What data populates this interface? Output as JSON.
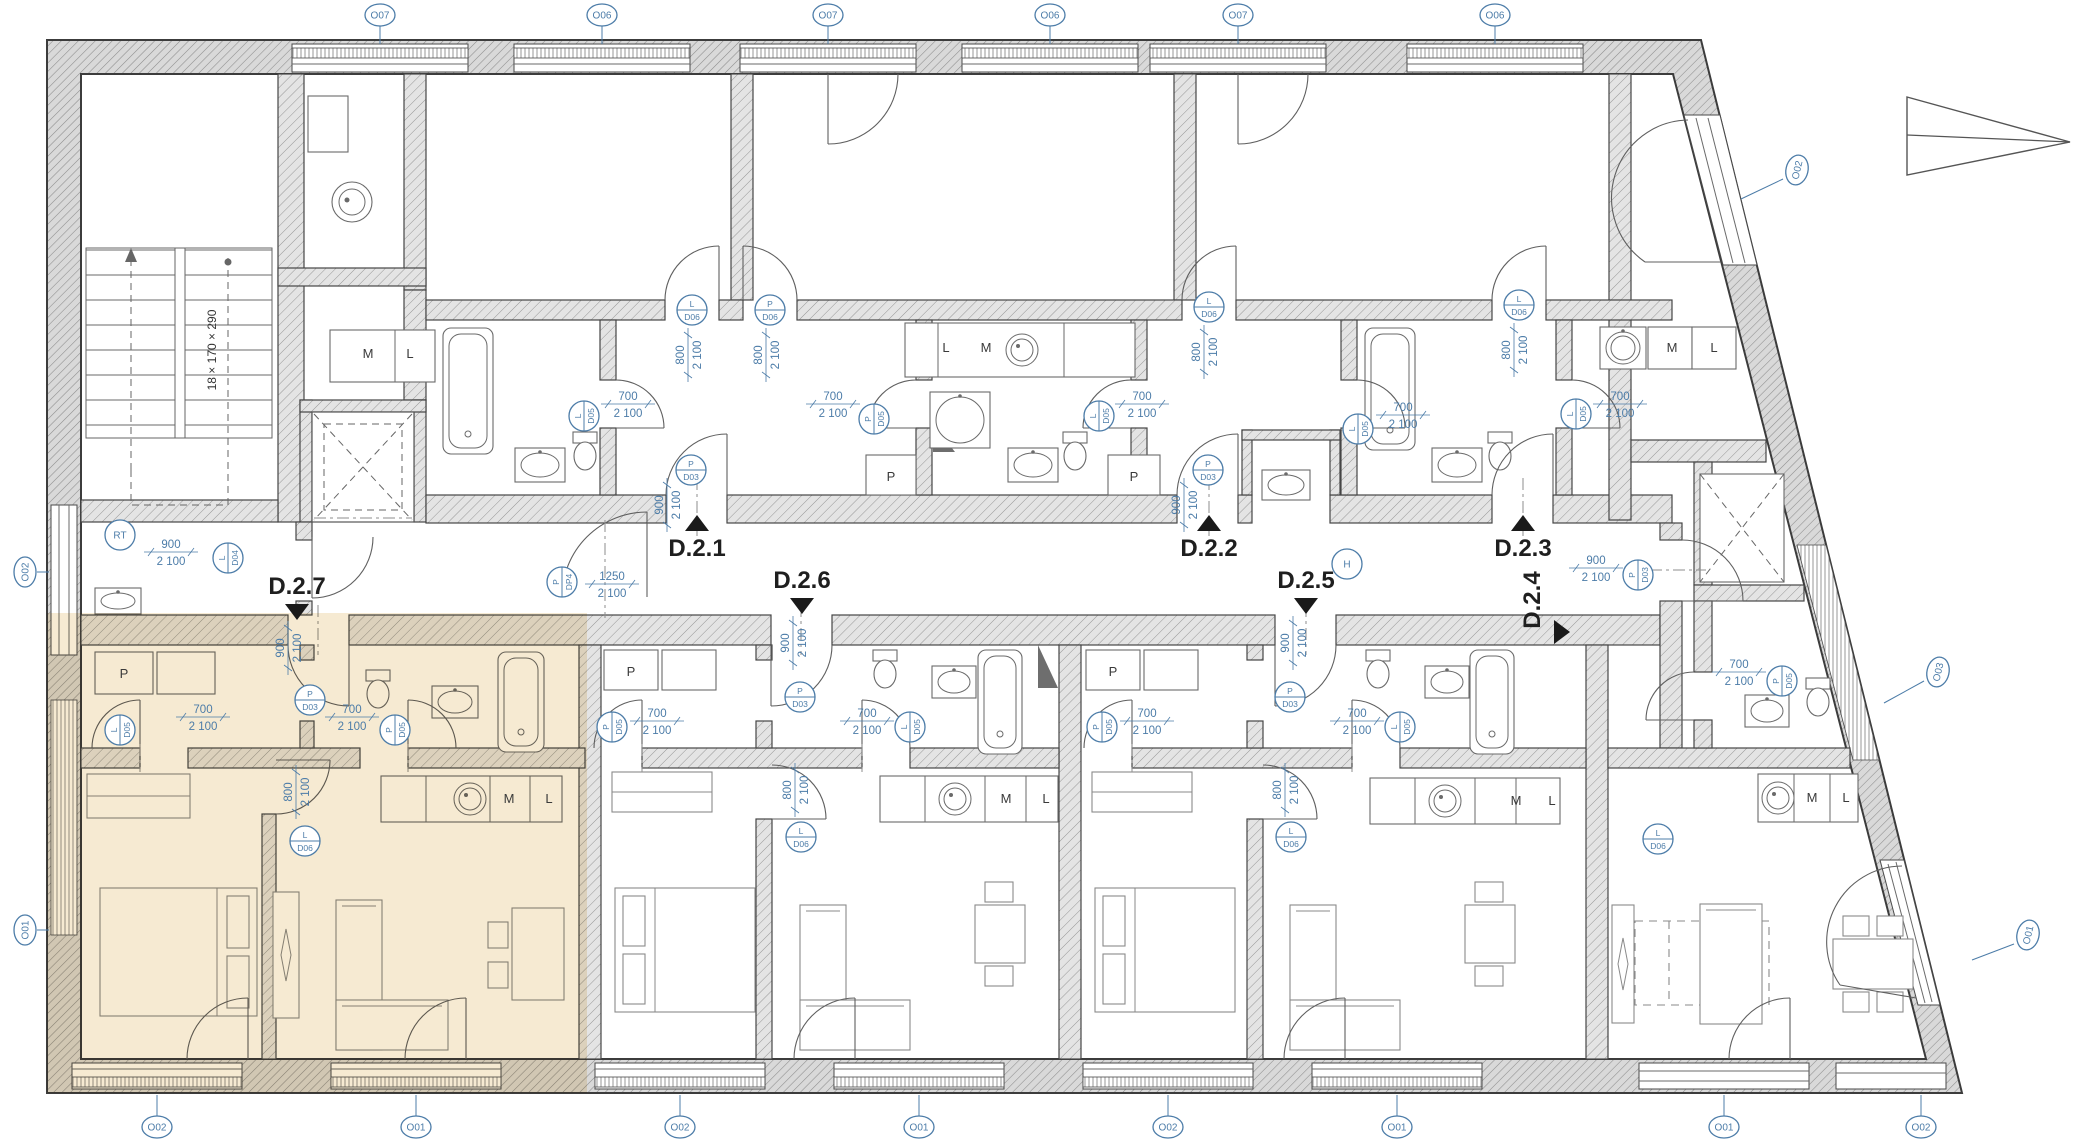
{
  "colors": {
    "accent": "#4c7ca8",
    "highlight": "#eed9ad",
    "wall_stroke": "#454545"
  },
  "stair": {
    "label": "18 × 170 × 290"
  },
  "unit_labels": [
    {
      "label": "D.2.1",
      "x": 697,
      "y": 556,
      "dir": "up"
    },
    {
      "label": "D.2.2",
      "x": 1209,
      "y": 556,
      "dir": "up"
    },
    {
      "label": "D.2.3",
      "x": 1523,
      "y": 556,
      "dir": "up"
    },
    {
      "label": "D.2.6",
      "x": 802,
      "y": 588,
      "dir": "down"
    },
    {
      "label": "D.2.5",
      "x": 1306,
      "y": 588,
      "dir": "down"
    },
    {
      "label": "D.2.7",
      "x": 297,
      "y": 594,
      "dir": "down"
    },
    {
      "label": "D.2.4",
      "x": 1540,
      "y": 600,
      "dir": "right",
      "rot": -90
    }
  ],
  "window_markers": [
    {
      "label": "O07",
      "x": 380,
      "y": 15,
      "rot": 0,
      "leader": [
        380,
        26,
        380,
        44
      ]
    },
    {
      "label": "O06",
      "x": 602,
      "y": 15,
      "rot": 0,
      "leader": [
        602,
        26,
        602,
        44
      ]
    },
    {
      "label": "O07",
      "x": 828,
      "y": 15,
      "rot": 0,
      "leader": [
        828,
        26,
        828,
        44
      ]
    },
    {
      "label": "O06",
      "x": 1050,
      "y": 15,
      "rot": 0,
      "leader": [
        1050,
        26,
        1050,
        44
      ]
    },
    {
      "label": "O07",
      "x": 1238,
      "y": 15,
      "rot": 0,
      "leader": [
        1238,
        26,
        1238,
        44
      ]
    },
    {
      "label": "O06",
      "x": 1495,
      "y": 15,
      "rot": 0,
      "leader": [
        1495,
        26,
        1495,
        44
      ]
    },
    {
      "label": "O02",
      "x": 157,
      "y": 1127,
      "rot": 0,
      "leader": [
        157,
        1116,
        157,
        1095
      ]
    },
    {
      "label": "O01",
      "x": 416,
      "y": 1127,
      "rot": 0,
      "leader": [
        416,
        1116,
        416,
        1095
      ]
    },
    {
      "label": "O02",
      "x": 680,
      "y": 1127,
      "rot": 0,
      "leader": [
        680,
        1116,
        680,
        1095
      ]
    },
    {
      "label": "O01",
      "x": 919,
      "y": 1127,
      "rot": 0,
      "leader": [
        919,
        1116,
        919,
        1095
      ]
    },
    {
      "label": "O02",
      "x": 1168,
      "y": 1127,
      "rot": 0,
      "leader": [
        1168,
        1116,
        1168,
        1095
      ]
    },
    {
      "label": "O01",
      "x": 1397,
      "y": 1127,
      "rot": 0,
      "leader": [
        1397,
        1116,
        1397,
        1095
      ]
    },
    {
      "label": "O01",
      "x": 1724,
      "y": 1127,
      "rot": 0,
      "leader": [
        1724,
        1116,
        1724,
        1095
      ]
    },
    {
      "label": "O02",
      "x": 1921,
      "y": 1127,
      "rot": 0,
      "leader": [
        1921,
        1116,
        1921,
        1095
      ]
    },
    {
      "label": "O02",
      "x": 25,
      "y": 572,
      "rot": -90,
      "leader": [
        37,
        572,
        49,
        572
      ]
    },
    {
      "label": "O01",
      "x": 25,
      "y": 930,
      "rot": -90,
      "leader": [
        37,
        930,
        49,
        930
      ]
    },
    {
      "label": "O02",
      "x": 1797,
      "y": 170,
      "rot": -77,
      "leader": [
        1783,
        179,
        1741,
        199
      ]
    },
    {
      "label": "O03",
      "x": 1938,
      "y": 672,
      "rot": -77,
      "leader": [
        1924,
        681,
        1884,
        703
      ]
    },
    {
      "label": "O01",
      "x": 2028,
      "y": 935,
      "rot": -77,
      "leader": [
        2014,
        944,
        1972,
        960
      ]
    }
  ],
  "door_markers": [
    {
      "letter": "L",
      "code": "D05",
      "x": 584,
      "y": 416,
      "rot": -90
    },
    {
      "letter": "P",
      "code": "D05",
      "x": 874,
      "y": 419,
      "rot": -90
    },
    {
      "letter": "P",
      "code": "D03",
      "x": 691,
      "y": 470,
      "rot": 0
    },
    {
      "letter": "L",
      "code": "D06",
      "x": 692,
      "y": 310,
      "rot": 0
    },
    {
      "letter": "P",
      "code": "D06",
      "x": 770,
      "y": 310,
      "rot": 0
    },
    {
      "letter": "L",
      "code": "D05",
      "x": 1099,
      "y": 416,
      "rot": -90
    },
    {
      "letter": "P",
      "code": "D03",
      "x": 1208,
      "y": 470,
      "rot": 0
    },
    {
      "letter": "L",
      "code": "D06",
      "x": 1209,
      "y": 307,
      "rot": 0
    },
    {
      "letter": "L",
      "code": "D05",
      "x": 1358,
      "y": 429,
      "rot": -90
    },
    {
      "letter": "L",
      "code": "D05",
      "x": 1576,
      "y": 414,
      "rot": -90
    },
    {
      "letter": "L",
      "code": "D06",
      "x": 1519,
      "y": 305,
      "rot": 0
    },
    {
      "letter": "L",
      "code": "D04",
      "x": 228,
      "y": 558,
      "rot": -90
    },
    {
      "letter": "P",
      "code": "DP4",
      "x": 562,
      "y": 582,
      "rot": -90
    },
    {
      "letter": "P",
      "code": "D03",
      "x": 1638,
      "y": 575,
      "rot": -90
    },
    {
      "letter": "L",
      "code": "D05",
      "x": 120,
      "y": 730,
      "rot": -90
    },
    {
      "letter": "P",
      "code": "D05",
      "x": 395,
      "y": 730,
      "rot": -90
    },
    {
      "letter": "P",
      "code": "D03",
      "x": 310,
      "y": 700,
      "rot": 0
    },
    {
      "letter": "L",
      "code": "D06",
      "x": 305,
      "y": 841,
      "rot": 0
    },
    {
      "letter": "P",
      "code": "D05",
      "x": 612,
      "y": 727,
      "rot": -90
    },
    {
      "letter": "L",
      "code": "D05",
      "x": 910,
      "y": 727,
      "rot": -90
    },
    {
      "letter": "P",
      "code": "D03",
      "x": 800,
      "y": 697,
      "rot": 0
    },
    {
      "letter": "L",
      "code": "D06",
      "x": 801,
      "y": 837,
      "rot": 0
    },
    {
      "letter": "P",
      "code": "D05",
      "x": 1102,
      "y": 727,
      "rot": -90
    },
    {
      "letter": "L",
      "code": "D05",
      "x": 1400,
      "y": 727,
      "rot": -90
    },
    {
      "letter": "P",
      "code": "D03",
      "x": 1290,
      "y": 697,
      "rot": 0
    },
    {
      "letter": "L",
      "code": "D06",
      "x": 1291,
      "y": 837,
      "rot": 0
    },
    {
      "letter": "P",
      "code": "D05",
      "x": 1782,
      "y": 681,
      "rot": -90
    },
    {
      "letter": "L",
      "code": "D06",
      "x": 1658,
      "y": 839,
      "rot": 0
    }
  ],
  "dim_labels": [
    {
      "w": "700",
      "h": "2 100",
      "x": 628,
      "y": 404,
      "rot": 0
    },
    {
      "w": "700",
      "h": "2 100",
      "x": 833,
      "y": 404,
      "rot": 0
    },
    {
      "w": "900",
      "h": "2 100",
      "x": 667,
      "y": 505,
      "rot": -90
    },
    {
      "w": "800",
      "h": "2 100",
      "x": 688,
      "y": 355,
      "rot": -90
    },
    {
      "w": "800",
      "h": "2 100",
      "x": 766,
      "y": 355,
      "rot": -90
    },
    {
      "w": "700",
      "h": "2 100",
      "x": 1142,
      "y": 404,
      "rot": 0
    },
    {
      "w": "900",
      "h": "2 100",
      "x": 1184,
      "y": 505,
      "rot": -90
    },
    {
      "w": "800",
      "h": "2 100",
      "x": 1204,
      "y": 352,
      "rot": -90
    },
    {
      "w": "700",
      "h": "2 100",
      "x": 1403,
      "y": 415,
      "rot": 0
    },
    {
      "w": "700",
      "h": "2 100",
      "x": 1620,
      "y": 404,
      "rot": 0
    },
    {
      "w": "800",
      "h": "2 100",
      "x": 1514,
      "y": 350,
      "rot": -90
    },
    {
      "w": "900",
      "h": "2 100",
      "x": 171,
      "y": 552,
      "rot": 0
    },
    {
      "w": "1250",
      "h": "2 100",
      "x": 612,
      "y": 584,
      "rot": 0
    },
    {
      "w": "900",
      "h": "2 100",
      "x": 1596,
      "y": 568,
      "rot": 0
    },
    {
      "w": "900",
      "h": "2 100",
      "x": 288,
      "y": 648,
      "rot": -90
    },
    {
      "w": "900",
      "h": "2 100",
      "x": 793,
      "y": 643,
      "rot": -90
    },
    {
      "w": "900",
      "h": "2 100",
      "x": 1293,
      "y": 643,
      "rot": -90
    },
    {
      "w": "700",
      "h": "2 100",
      "x": 203,
      "y": 717,
      "rot": 0
    },
    {
      "w": "700",
      "h": "2 100",
      "x": 352,
      "y": 717,
      "rot": 0
    },
    {
      "w": "700",
      "h": "2 100",
      "x": 657,
      "y": 721,
      "rot": 0
    },
    {
      "w": "700",
      "h": "2 100",
      "x": 867,
      "y": 721,
      "rot": 0
    },
    {
      "w": "700",
      "h": "2 100",
      "x": 1147,
      "y": 721,
      "rot": 0
    },
    {
      "w": "700",
      "h": "2 100",
      "x": 1357,
      "y": 721,
      "rot": 0
    },
    {
      "w": "800",
      "h": "2 100",
      "x": 296,
      "y": 792,
      "rot": -90
    },
    {
      "w": "800",
      "h": "2 100",
      "x": 795,
      "y": 790,
      "rot": -90
    },
    {
      "w": "800",
      "h": "2 100",
      "x": 1285,
      "y": 790,
      "rot": -90
    },
    {
      "w": "700",
      "h": "2 100",
      "x": 1739,
      "y": 672,
      "rot": 0
    }
  ],
  "room_labels": [
    {
      "label": "M",
      "x": 368,
      "y": 358
    },
    {
      "label": "L",
      "x": 410,
      "y": 358
    },
    {
      "label": "L",
      "x": 946,
      "y": 352
    },
    {
      "label": "M",
      "x": 986,
      "y": 352
    },
    {
      "label": "M",
      "x": 1672,
      "y": 352
    },
    {
      "label": "L",
      "x": 1714,
      "y": 352
    },
    {
      "label": "P",
      "x": 891,
      "y": 481
    },
    {
      "label": "P",
      "x": 1134,
      "y": 481
    },
    {
      "label": "P",
      "x": 124,
      "y": 678
    },
    {
      "label": "P",
      "x": 631,
      "y": 676
    },
    {
      "label": "P",
      "x": 1113,
      "y": 676
    },
    {
      "label": "M",
      "x": 509,
      "y": 803
    },
    {
      "label": "L",
      "x": 549,
      "y": 803
    },
    {
      "label": "M",
      "x": 1006,
      "y": 803
    },
    {
      "label": "L",
      "x": 1046,
      "y": 803
    },
    {
      "label": "M",
      "x": 1516,
      "y": 805
    },
    {
      "label": "L",
      "x": 1552,
      "y": 805
    },
    {
      "label": "M",
      "x": 1812,
      "y": 802
    },
    {
      "label": "L",
      "x": 1846,
      "y": 802
    }
  ],
  "circle_labels": [
    {
      "label": "RT",
      "x": 120,
      "y": 535
    },
    {
      "label": "H",
      "x": 1347,
      "y": 564
    }
  ]
}
